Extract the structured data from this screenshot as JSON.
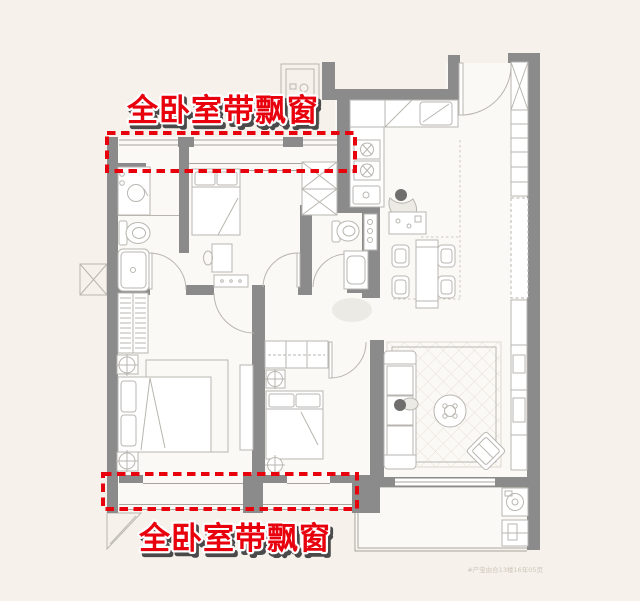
{
  "annotations": {
    "top_label": "全卧室带飘窗",
    "bottom_label": "全卧室带飘窗"
  },
  "watermark": {
    "text": "#产宝由合13楼16年05页"
  },
  "highlights": {
    "top": {
      "x": 107,
      "y": 133,
      "width": 248,
      "height": 38
    },
    "bottom": {
      "x": 103,
      "y": 474,
      "width": 254,
      "height": 35
    }
  },
  "colors": {
    "background": "#f6f1ea",
    "floor": "#fbf9f5",
    "wall": "#8b8b8b",
    "furniture_line": "#b9b6b0",
    "accent_red": "#e8000d",
    "label_shadow": "#4a4a4a",
    "watermark_color": "#cdc6bc"
  }
}
